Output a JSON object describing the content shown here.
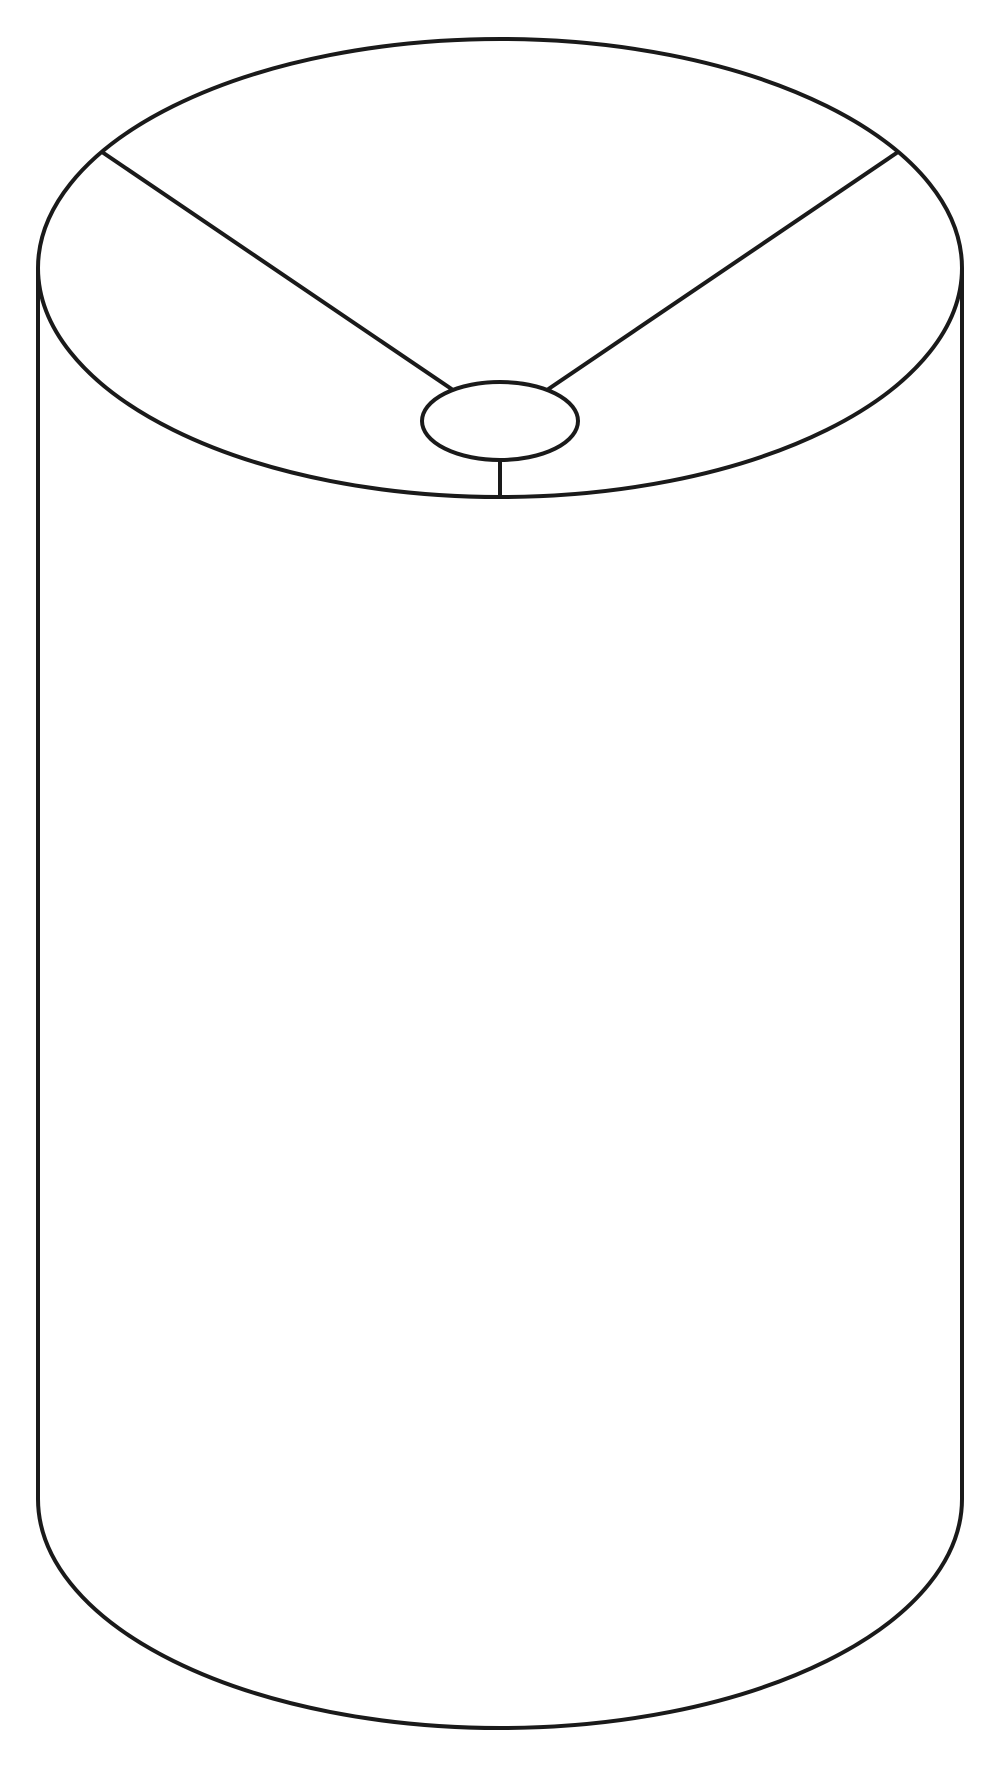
{
  "page": {
    "background_color": "#ffffff",
    "description": "Black line drawing of a cylindrical drum lampshade seen from slightly above: full top rim ellipse, small central spider fitter ring joined to the rim by three spokes, straight cylinder sides and curved bottom front edge"
  },
  "drawing": {
    "canvas": {
      "width": 1000,
      "height": 1770
    },
    "stroke": {
      "color": "#1a1a1a",
      "width": 4,
      "fill": "none"
    },
    "shapes": [
      {
        "name": "top-rim-ellipse",
        "type": "ellipse",
        "cx": 500,
        "cy": 268,
        "rx": 462,
        "ry": 229
      },
      {
        "name": "left-side-line",
        "type": "line",
        "x1": 38,
        "y1": 268,
        "x2": 38,
        "y2": 1499
      },
      {
        "name": "right-side-line",
        "type": "line",
        "x1": 962,
        "y1": 268,
        "x2": 962,
        "y2": 1499
      },
      {
        "name": "bottom-rim-arc",
        "type": "path",
        "d": "M 38 1499 A 462 229 0 0 0 962 1499"
      },
      {
        "name": "fitter-ring-ellipse",
        "type": "ellipse",
        "cx": 500,
        "cy": 421,
        "rx": 78,
        "ry": 39
      },
      {
        "name": "spoke-upper-left-line",
        "type": "line",
        "x1": 102,
        "y1": 152,
        "x2": 453,
        "y2": 390
      },
      {
        "name": "spoke-upper-right-line",
        "type": "line",
        "x1": 898,
        "y1": 152,
        "x2": 547,
        "y2": 390
      },
      {
        "name": "spoke-bottom-line",
        "type": "line",
        "x1": 500,
        "y1": 460,
        "x2": 500,
        "y2": 497
      }
    ]
  }
}
